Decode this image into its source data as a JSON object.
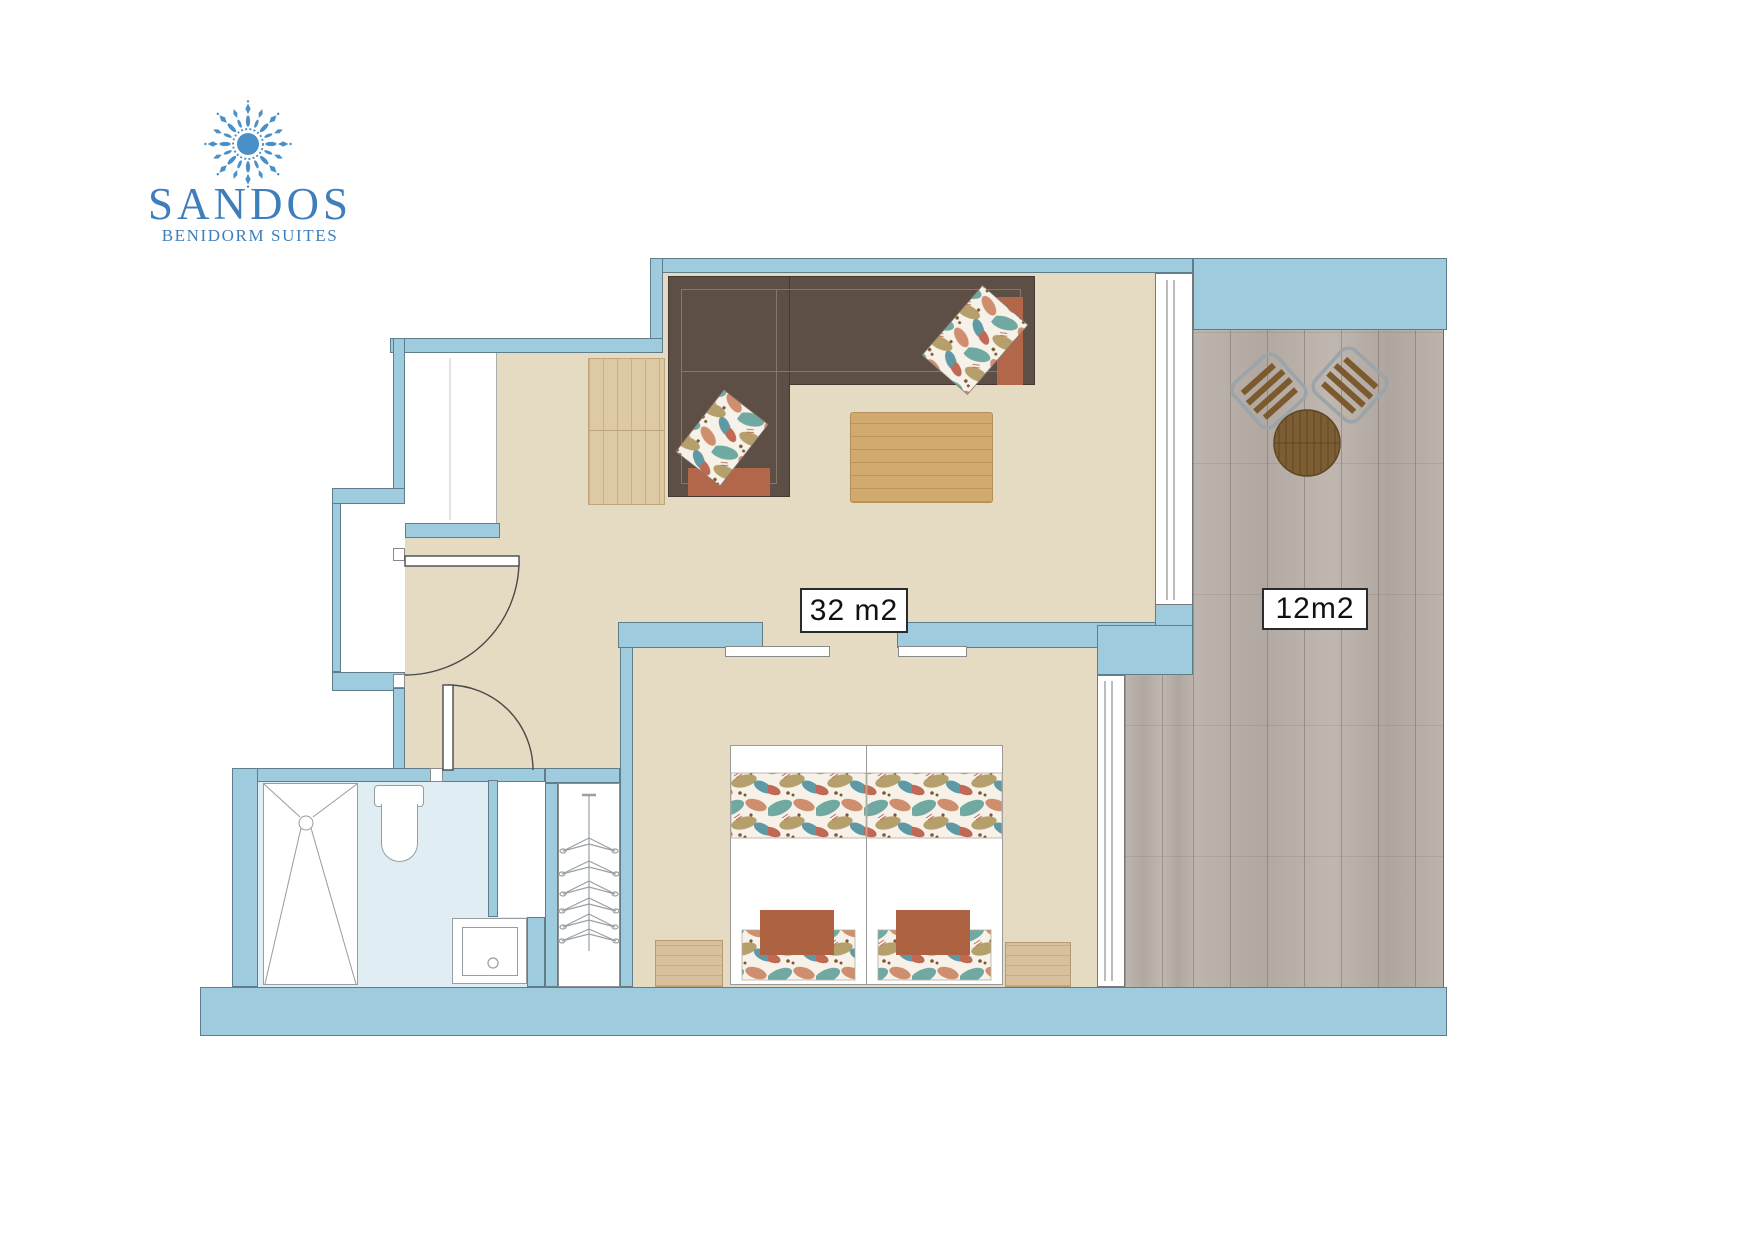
{
  "brand": {
    "name": "SANDOS",
    "subtitle": "BENIDORM SUITES",
    "logo_icon": "sunburst-mandala-icon",
    "logo_color": "#3e7ebc"
  },
  "labels": {
    "living_area": "32 m2",
    "terrace_area": "12m2"
  },
  "colors": {
    "wall": "#9ecbdd",
    "interior_floor": "#e4dbc2",
    "bathroom_floor": "#e0edf3",
    "terrace_floor": "#b9b0aa",
    "sofa": "#5d4e46",
    "accent_terracotta": "#b2664a",
    "wood_light": "#ddc9a4",
    "wood_table": "#d2aa70"
  }
}
